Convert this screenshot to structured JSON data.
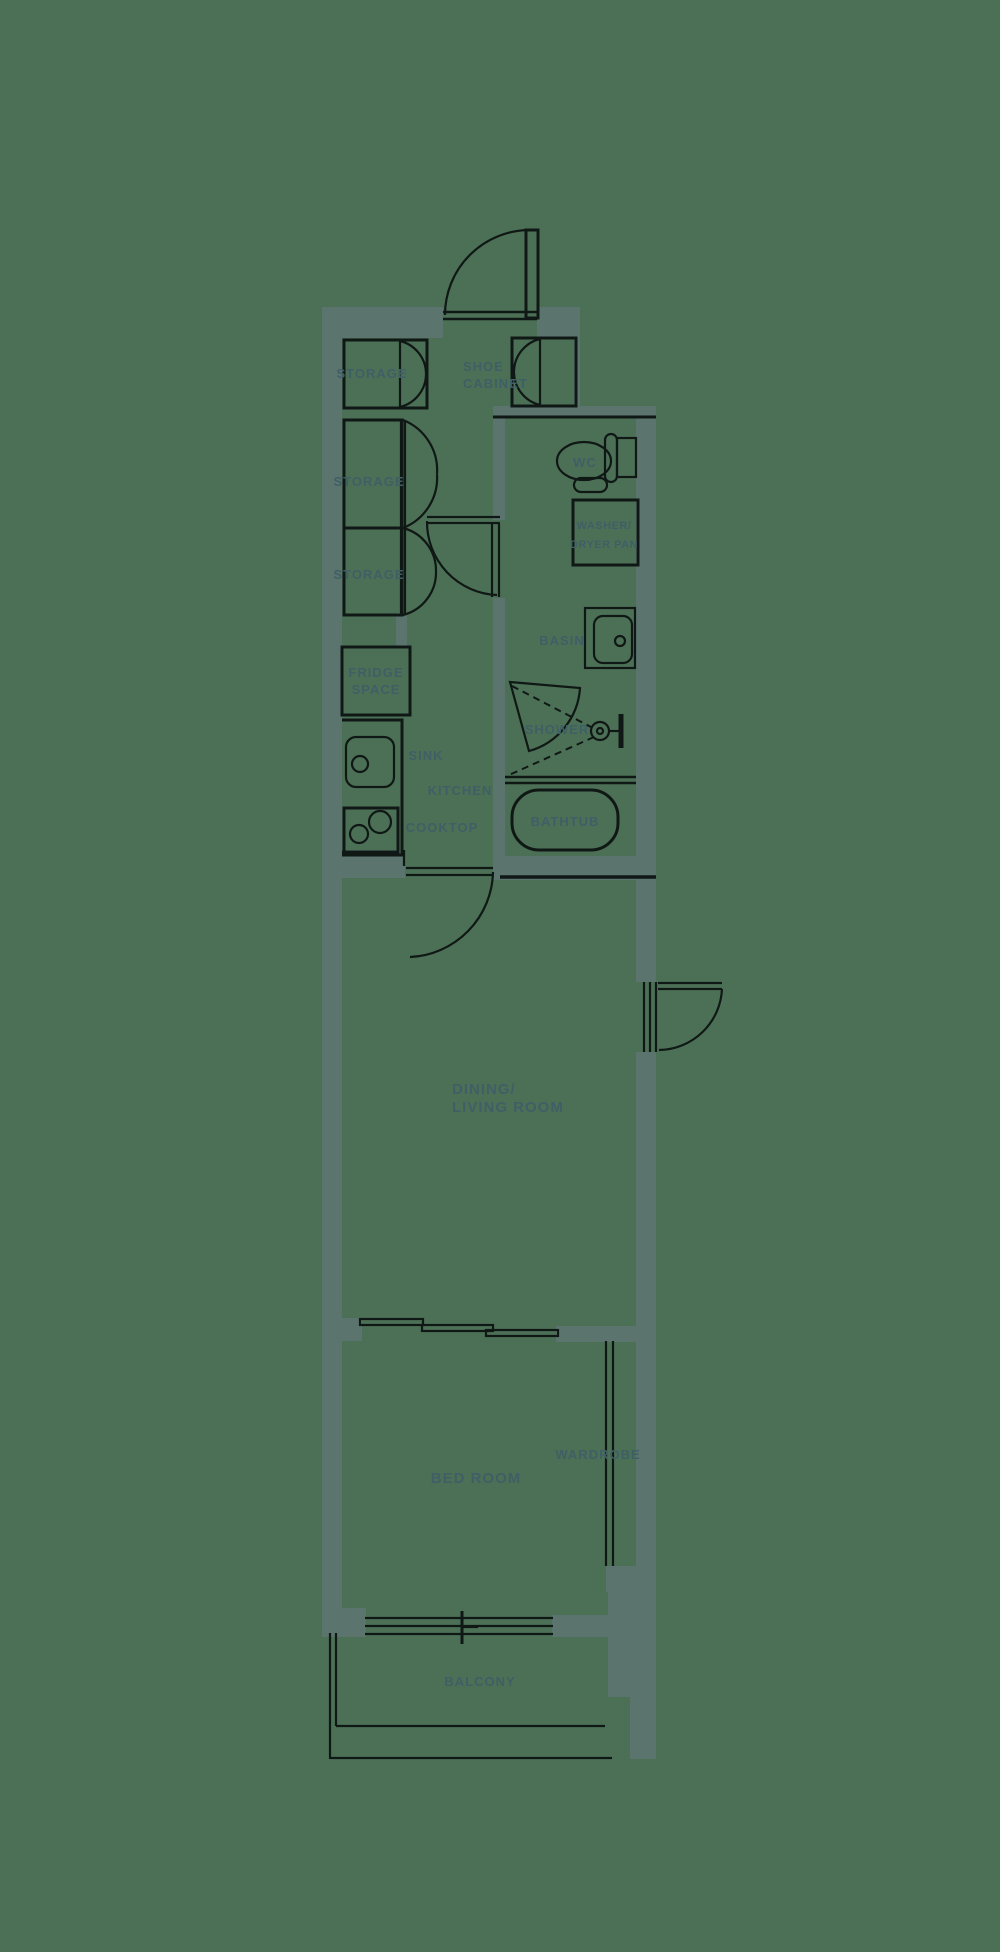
{
  "floorplan": {
    "background_color": "#4c7056",
    "wall_color": "#5b756e",
    "line_color": "#101815",
    "label_color": "#3f5f66",
    "labels": {
      "storage1": "STORAGE",
      "shoe_cabinet_line1": "SHOE",
      "shoe_cabinet_line2": "CABINET",
      "storage2": "STORAGE",
      "storage3": "STORAGE",
      "wc": "WC",
      "washer_line1": "WASHER/",
      "washer_line2": "DRYER PAN",
      "fridge_line1": "FRIDGE",
      "fridge_line2": "SPACE",
      "basin": "BASIN",
      "shower": "SHOWER",
      "sink": "SINK",
      "kitchen": "KITCHEN",
      "cooktop": "COOKTOP",
      "bathtub": "BATHTUB",
      "dining_line1": "DINING/",
      "dining_line2": "LIVING ROOM",
      "bedroom": "BED ROOM",
      "wardrobe": "WARDROBE",
      "balcony": "BALCONY"
    }
  }
}
